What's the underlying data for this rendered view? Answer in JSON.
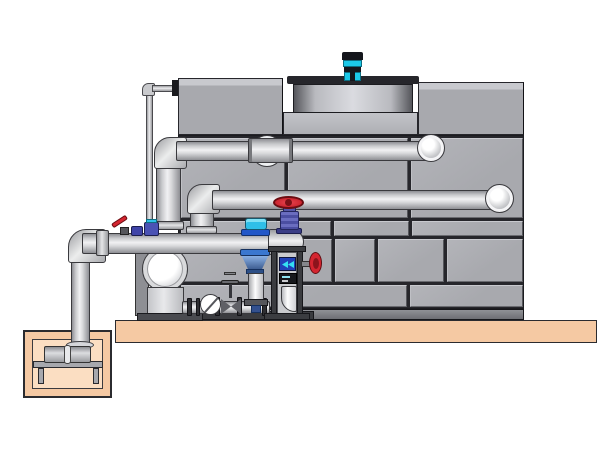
{
  "scene": {
    "kind": "technical 3D illustration",
    "subject": "closed-circuit cooling tower with fan motor, external piping, centrifugal pump skid and below-grade sump pump pit",
    "background_color": "#ffffff",
    "visible_text": ""
  },
  "colors": {
    "background": "#ffffff",
    "outline": "#26262b",
    "wall_panel": "#a8a9ae",
    "wall_panel_light": "#c8c9ce",
    "wall_panel_dark": "#6a6b70",
    "wall_seam": "#26262b",
    "box_face": "#a8a9ae",
    "deck_band": "#b9bac0",
    "cowl_dark": "#55565b",
    "cowl_light": "#dadbe0",
    "flange_black": "#26262b",
    "motor_cyan": "#1cc8e8",
    "motor_black": "#14161c",
    "pipe_light": "#f1f1f3",
    "pipe_mid": "#c9cacd",
    "pipe_shadow": "#8e8f94",
    "pipe_outline": "#3a3a3e",
    "slab": "#f5c9a3",
    "pit_inner": "#fbdec2",
    "valve_red": "#d42530",
    "valve_blue": "#5558a8",
    "device_blue": "#2141b8",
    "actuator_cyan": "#2fbfe8",
    "strainer_blue": "#4a6fa8",
    "frame_dark": "#3b3c40",
    "steel_gray": "#a7a8ad",
    "white_pipe": "#fdfdfd"
  },
  "components": {
    "tower": [
      "panelled casing wall",
      "base channel",
      "upper left casing box",
      "upper right casing box",
      "fan deck band",
      "fan cowl with black top flange",
      "cyan fan motor"
    ],
    "piping": [
      "thin makeup line with top elbow and black wall flange",
      "upper return pipe with coupling sleeve and wall elbow ring",
      "middle supply pipe with wall elbow ring",
      "riser 1",
      "riser 2",
      "pump discharge manifold with left elbow",
      "sump downcomer pipe",
      "suction line with flanges"
    ],
    "pump_skid": [
      "end-suction centrifugal pump volute",
      "pump base",
      "sight glass",
      "gate valve with tee handle",
      "vertical column with blue suction strainer",
      "cyan butterfly-valve actuator",
      "blue globe valve with red handwheel",
      "side red handwheel valve",
      "control frame with blue flow device, controller panel and white elbow",
      "red-lever ball valve",
      "blue dosing fittings",
      "skid base rail"
    ],
    "sump": [
      "concrete slab",
      "sump pit walls",
      "pit cavity",
      "pump stand with legs",
      "horizontal sump pump (two cylinders with coupling)"
    ]
  }
}
